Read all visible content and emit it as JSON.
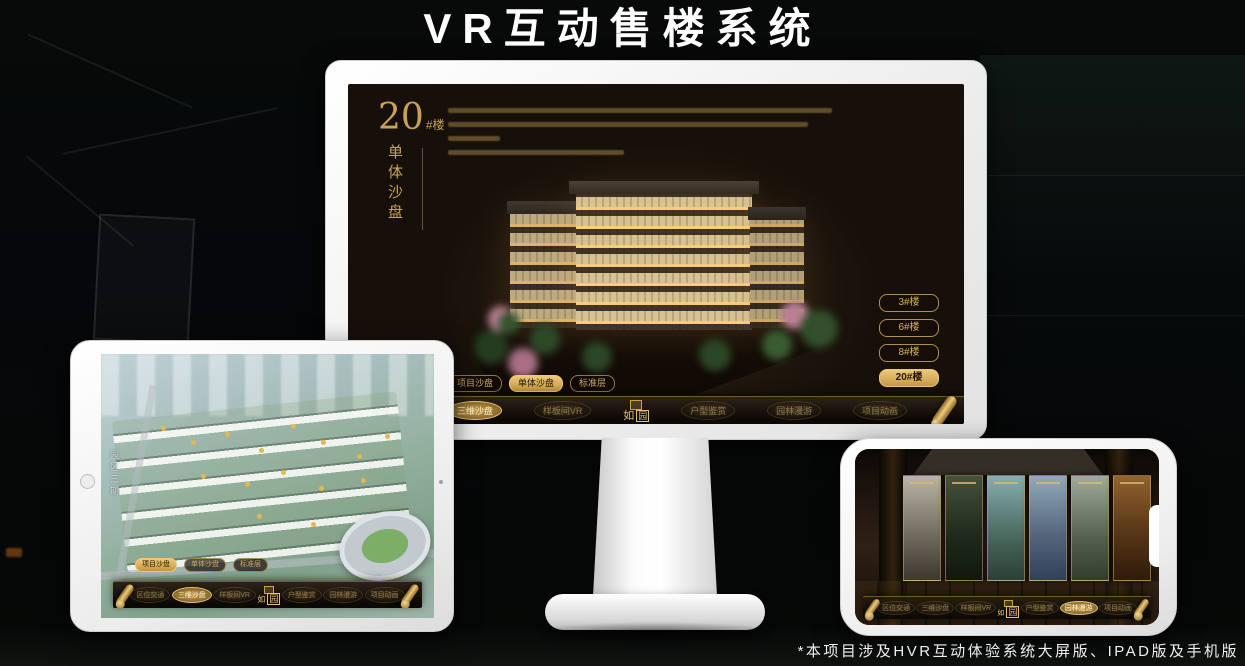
{
  "title": "VR互动售楼系统",
  "footnote": "*本项目涉及HVR互动体验系统大屏版、IPAD版及手机版",
  "logo": {
    "char1": "如",
    "char2": "园"
  },
  "monitor_screen": {
    "heading_number": "20",
    "heading_suffix": "#楼",
    "heading_vertical": "单体沙盘",
    "floor_buttons": [
      {
        "label": "3#楼"
      },
      {
        "label": "6#楼"
      },
      {
        "label": "8#楼"
      },
      {
        "label": "20#楼"
      }
    ],
    "active_floor": "20#楼"
  },
  "mode_tabs": {
    "labels": [
      "项目沙盘",
      "单体沙盘",
      "标准层"
    ],
    "monitor_active": "单体沙盘",
    "ipad_active": "项目沙盘"
  },
  "nav": {
    "items": [
      "区位交通",
      "三维沙盘",
      "样板间VR",
      "户型鉴赏",
      "园林漫游",
      "项目动画"
    ],
    "monitor_active": "三维沙盘",
    "ipad_active": "三维沙盘",
    "phone_active": "园林漫游"
  },
  "ipad": {
    "side_label": "园区三期"
  },
  "colors": {
    "gold": "#c9a158",
    "gold_bright": "#e8c573",
    "screen_bg": "#17100a",
    "page_bg": "#060806"
  }
}
